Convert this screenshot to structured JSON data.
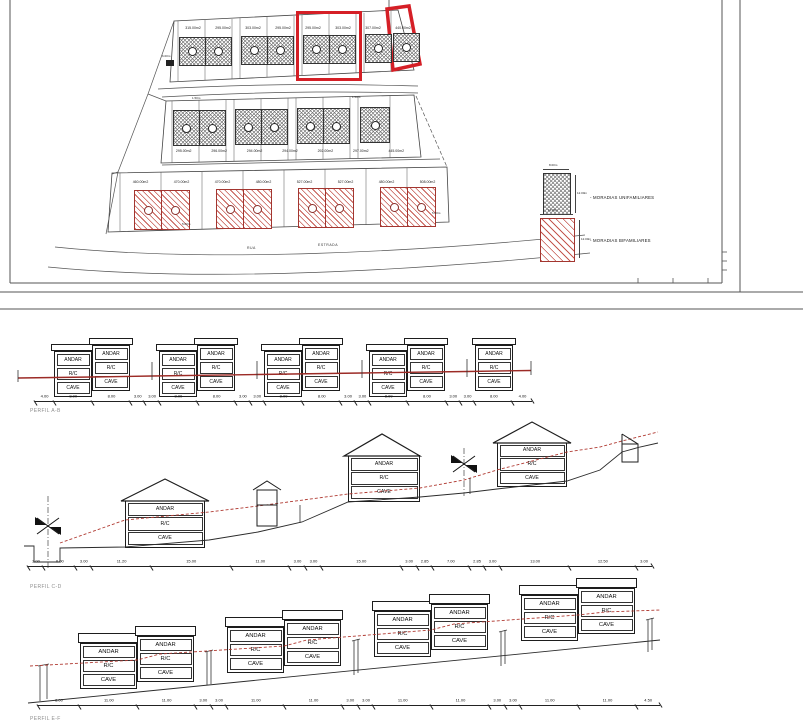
{
  "colors": {
    "highlight_red": "#d51f26",
    "hatch_red": "#c4574f",
    "hatch_gray": "#777777",
    "profile_ground_red": "#9c2b26",
    "line_black": "#222222"
  },
  "site_plan": {
    "rows": {
      "top": {
        "plots": [
          "315.00m2",
          "295.00m2",
          "303.00m2",
          "295.00m2",
          "295.00m2",
          "303.00m2",
          "307.00m2",
          "440.00m2"
        ]
      },
      "middle": {
        "plots": [
          "295.00m2",
          "296.00m2",
          "294.00m2",
          "294.00m2",
          "292.00m2",
          "297.00m2",
          "445.00m2"
        ]
      },
      "bottom": {
        "plots": [
          "460.00m2",
          "470.00m2",
          "470.00m2",
          "480.00m2",
          "527.00m2",
          "527.00m2",
          "480.00m2",
          "508.00m2"
        ]
      }
    },
    "micro_dims": {
      "row_top_left": "6.00m",
      "row_mid_a": "1.50m",
      "row_mid_b": "1.50m",
      "row_bottom_a": "5.00m",
      "row_bottom_b": "5.00m"
    },
    "roads": {
      "rua": "RUA",
      "estrada": "ESTRADA"
    },
    "legend": {
      "unifamiliar": {
        "label": "- MORADIAS UNIFAMILIARES",
        "width": "8.00m",
        "height": "12.00m"
      },
      "bifamiliar": {
        "label": "- MORADIAS BIFAMILIARES",
        "width": "11.00m",
        "height": "12.00m"
      }
    }
  },
  "labels": {
    "andar": "ANDAR",
    "rc": "R/C",
    "cave": "CAVE"
  },
  "profiles": {
    "ab": {
      "name": "PERFIL A-B",
      "dims": [
        "4.00",
        "8.00",
        "8.00",
        "3.00",
        "3.00",
        "8.00",
        "8.00",
        "3.00",
        "3.00",
        "8.00",
        "8.00",
        "3.00",
        "3.00",
        "8.00",
        "8.00",
        "3.00",
        "3.00",
        "8.00",
        "4.00"
      ]
    },
    "cd": {
      "name": "PERFIL C-D",
      "dims": [
        "3.00",
        "6.00",
        "3.00",
        "11.20",
        "15.00",
        "11.00",
        "3.00",
        "3.00",
        "15.00",
        "3.00",
        "2.85",
        "7.00",
        "2.85",
        "3.00",
        "13.00",
        "12.50",
        "3.00"
      ]
    },
    "ef": {
      "name": "PERFIL E-F",
      "dims": [
        "8.00",
        "11.00",
        "11.00",
        "3.00",
        "3.00",
        "11.00",
        "11.00",
        "3.00",
        "3.00",
        "11.00",
        "11.00",
        "3.00",
        "3.00",
        "11.00",
        "11.00",
        "4.50"
      ]
    }
  }
}
